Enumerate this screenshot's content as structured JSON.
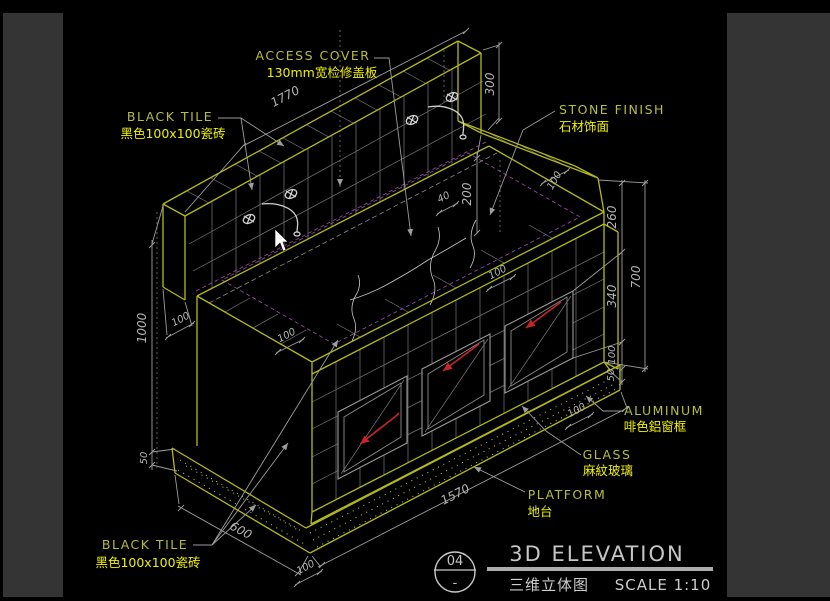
{
  "labels": {
    "black_tile": {
      "en": "BLACK TILE",
      "zh": "黑色100x100瓷砖"
    },
    "access_cover": {
      "en": "ACCESS COVER",
      "zh": "130mm宽检修盖板"
    },
    "stone_finish": {
      "en": "STONE FINISH",
      "zh": "石材饰面"
    },
    "aluminum": {
      "en": "ALUMINUM",
      "zh": "啡色鋁窗框"
    },
    "glass": {
      "en": "GLASS",
      "zh": "麻紋玻璃"
    },
    "platform": {
      "en": "PLATFORM",
      "zh": "地台"
    }
  },
  "dims": {
    "top_length": "1770",
    "backsplash_height": "300",
    "step_height": "200",
    "slab_thickness": "40",
    "return_width": "100",
    "right_260": "260",
    "right_340": "340",
    "right_100": "100",
    "right_50": "50",
    "right_700": "700",
    "left_1000": "1000",
    "left_50": "50",
    "wall_thickness": "100",
    "counter_border_left": "100",
    "counter_border_right": "100",
    "depth_600": "600",
    "front_length": "1570",
    "platform_height_left": "100",
    "platform_height_right": "100"
  },
  "title_block": {
    "detail_number": "04",
    "separator": "-",
    "title_en": "3D ELEVATION",
    "title_zh": "三维立体图",
    "scale": "SCALE 1:10"
  },
  "colors": {
    "canvas_bg": "#000000",
    "panel_bg": "#343434",
    "cad_yellow": "#b5b919",
    "label_yellow": "#f0f000",
    "dim_gray": "#b5b5b5",
    "arrow_red": "#c52525"
  }
}
